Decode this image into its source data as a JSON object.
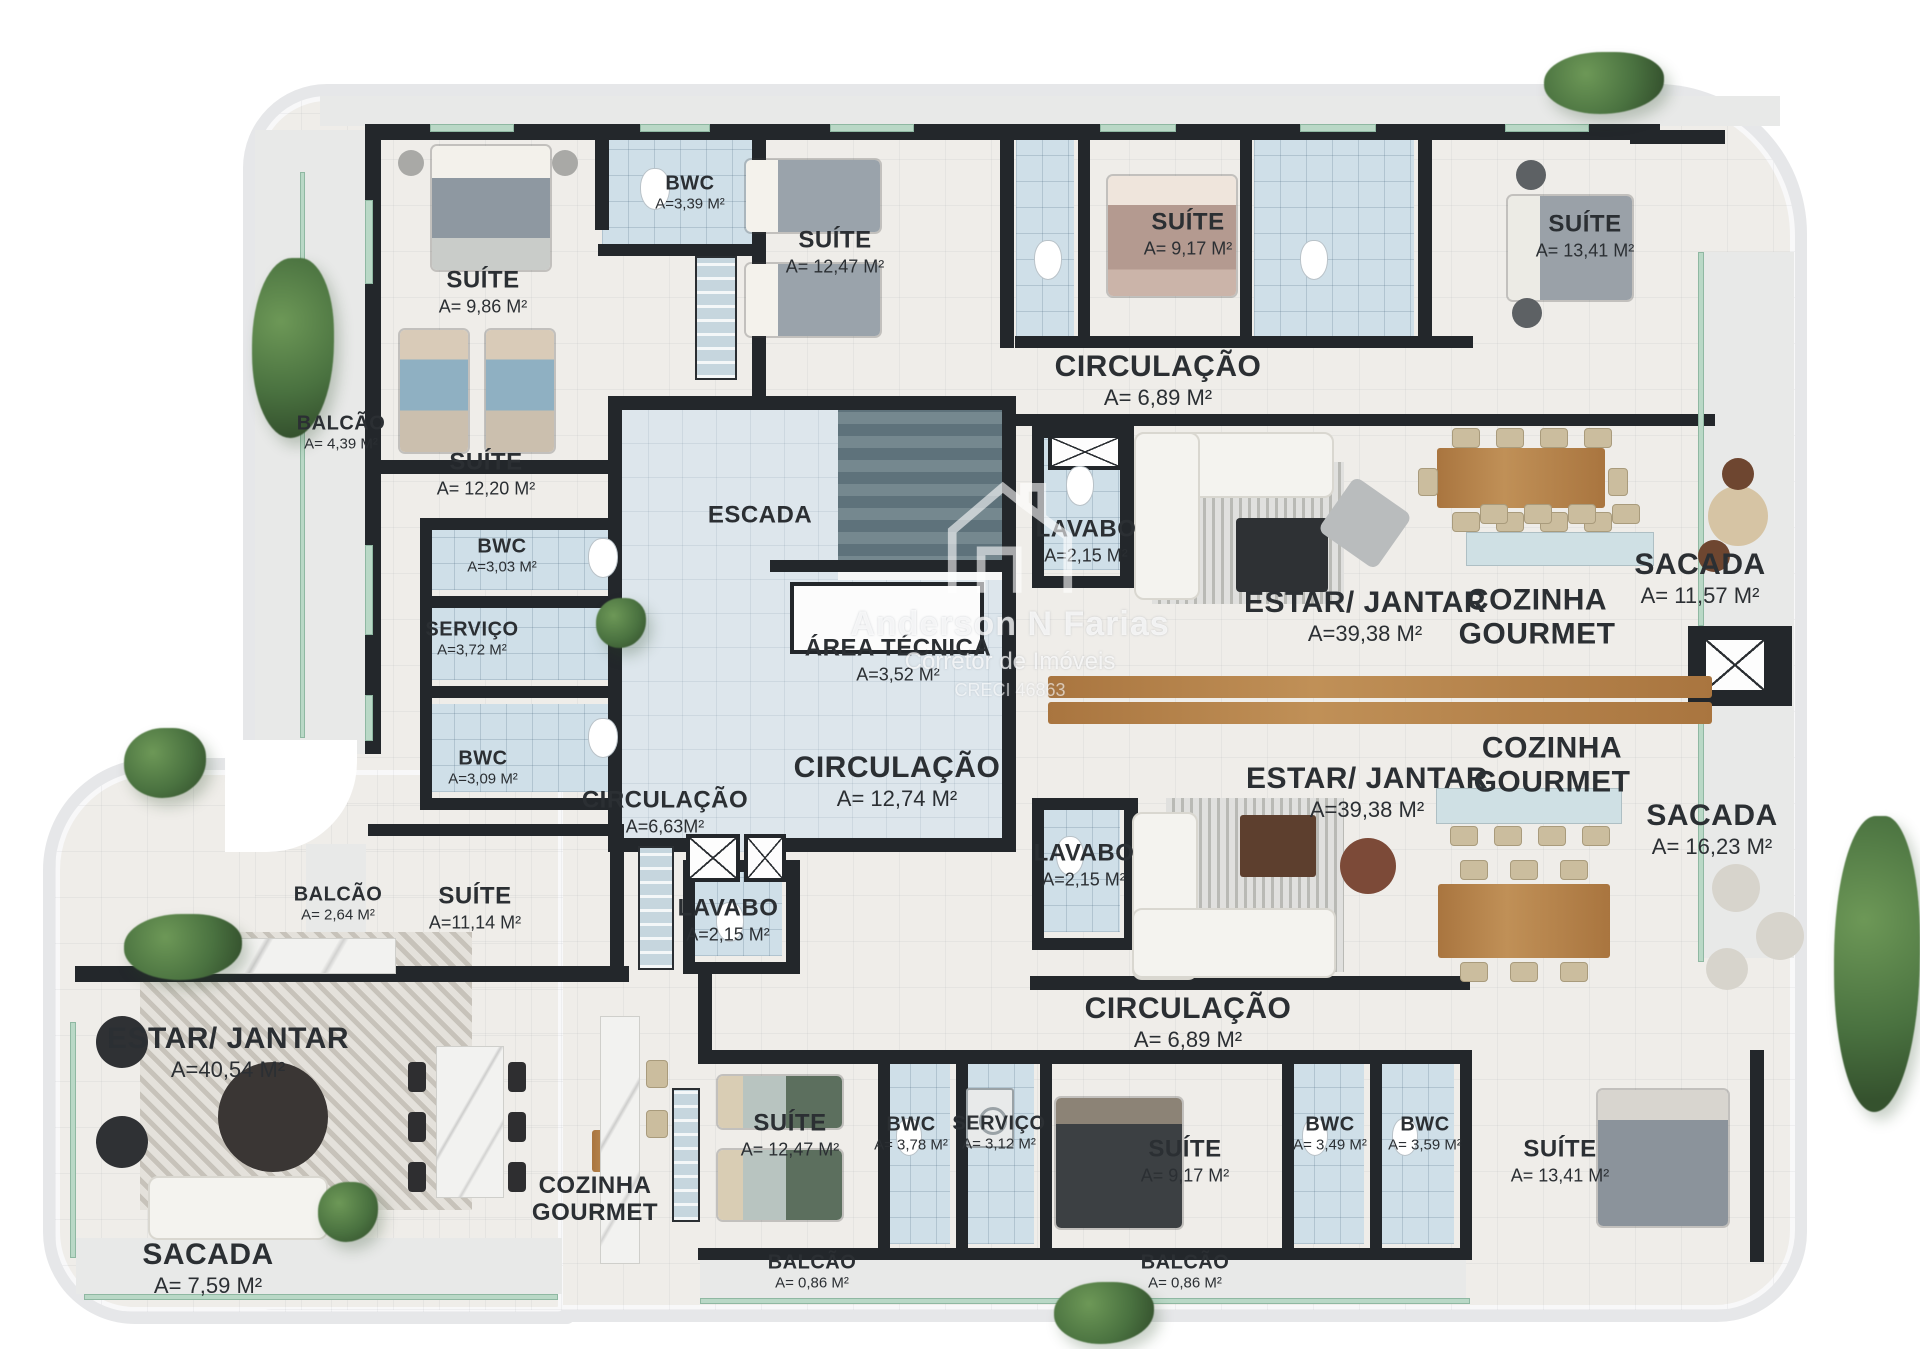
{
  "watermark": {
    "line1": "Anderson N Farias",
    "line2": "Corretor de Imóveis",
    "line3": "CRECI 46863"
  },
  "rooms": [
    {
      "label": "SUÍTE",
      "area": "A= 9,86 m²",
      "x": 483,
      "y": 292,
      "size": "m"
    },
    {
      "label": "BWC",
      "area": "A=3,39 m²",
      "x": 690,
      "y": 193,
      "size": "s"
    },
    {
      "label": "SUÍTE",
      "area": "A= 12,47 m²",
      "x": 835,
      "y": 252,
      "size": "m"
    },
    {
      "label": "SUÍTE",
      "area": "A= 9,17 m²",
      "x": 1188,
      "y": 234,
      "size": "m"
    },
    {
      "label": "SUÍTE",
      "area": "A= 13,41 m²",
      "x": 1585,
      "y": 236,
      "size": "m"
    },
    {
      "label": "CIRCULAÇÃO",
      "area": "A= 6,89 m²",
      "x": 1158,
      "y": 380,
      "size": "l"
    },
    {
      "label": "BALCÃO",
      "area": "A= 4,39 m²",
      "x": 341,
      "y": 433,
      "size": "s"
    },
    {
      "label": "SUÍTE",
      "area": "A= 12,20 m²",
      "x": 486,
      "y": 474,
      "size": "m"
    },
    {
      "label": "BWC",
      "area": "A=3,03 m²",
      "x": 502,
      "y": 556,
      "size": "s"
    },
    {
      "label": "SERVIÇO",
      "area": "A=3,72 m²",
      "x": 472,
      "y": 639,
      "size": "s"
    },
    {
      "label": "BWC",
      "area": "A=3,09 m²",
      "x": 483,
      "y": 768,
      "size": "s"
    },
    {
      "label": "ESCADA",
      "area": "",
      "x": 760,
      "y": 516,
      "size": "m"
    },
    {
      "label": "ÁREA TÉCNICA",
      "area": "A=3,52 m²",
      "x": 898,
      "y": 660,
      "size": "m"
    },
    {
      "label": "LAVABO",
      "area": "A=2,15 m²",
      "x": 1086,
      "y": 541,
      "size": "m"
    },
    {
      "label": "ESTAR/ JANTAR",
      "area": "A=39,38 m²",
      "x": 1365,
      "y": 616,
      "size": "l"
    },
    {
      "label": "COZINHA\nGOURMET",
      "area": "",
      "x": 1537,
      "y": 617,
      "size": "l"
    },
    {
      "label": "SACADA",
      "area": "A= 11,57 m²",
      "x": 1700,
      "y": 578,
      "size": "l"
    },
    {
      "label": "CIRCULAÇÃO",
      "area": "A= 12,74 m²",
      "x": 897,
      "y": 781,
      "size": "l"
    },
    {
      "label": "CIRCULAÇÃO",
      "area": "A=6,63m²",
      "x": 665,
      "y": 812,
      "size": "m"
    },
    {
      "label": "ESTAR/ JANTAR",
      "area": "A=39,38 m²",
      "x": 1367,
      "y": 792,
      "size": "l"
    },
    {
      "label": "COZINHA\nGOURMET",
      "area": "",
      "x": 1552,
      "y": 765,
      "size": "l"
    },
    {
      "label": "SACADA",
      "area": "A= 16,23 m²",
      "x": 1712,
      "y": 829,
      "size": "l"
    },
    {
      "label": "LAVABO",
      "area": "A=2,15 m²",
      "x": 1084,
      "y": 865,
      "size": "m"
    },
    {
      "label": "BALCÃO",
      "area": "A= 2,64 m²",
      "x": 338,
      "y": 904,
      "size": "s"
    },
    {
      "label": "SUÍTE",
      "area": "A=11,14 m²",
      "x": 475,
      "y": 908,
      "size": "m"
    },
    {
      "label": "LAVABO",
      "area": "A=2,15 m²",
      "x": 728,
      "y": 920,
      "size": "m"
    },
    {
      "label": "ESTAR/ JANTAR",
      "area": "A=40,54 m²",
      "x": 228,
      "y": 1052,
      "size": "l"
    },
    {
      "label": "COZINHA\nGOURMET",
      "area": "",
      "x": 595,
      "y": 1200,
      "size": "m"
    },
    {
      "label": "SACADA",
      "area": "A= 7,59 m²",
      "x": 208,
      "y": 1268,
      "size": "l"
    },
    {
      "label": "CIRCULAÇÃO",
      "area": "A= 6,89 m²",
      "x": 1188,
      "y": 1022,
      "size": "l"
    },
    {
      "label": "SUÍTE",
      "area": "A= 12,47 m²",
      "x": 790,
      "y": 1135,
      "size": "m"
    },
    {
      "label": "BWC",
      "area": "A= 3,78 m²",
      "x": 911,
      "y": 1134,
      "size": "s"
    },
    {
      "label": "SERVIÇO",
      "area": "A= 3,12 m²",
      "x": 999,
      "y": 1133,
      "size": "s"
    },
    {
      "label": "SUÍTE",
      "area": "A= 9,17 m²",
      "x": 1185,
      "y": 1161,
      "size": "m"
    },
    {
      "label": "BWC",
      "area": "A= 3,49 m²",
      "x": 1330,
      "y": 1134,
      "size": "s"
    },
    {
      "label": "BWC",
      "area": "A= 3,59 m²",
      "x": 1425,
      "y": 1134,
      "size": "s"
    },
    {
      "label": "SUÍTE",
      "area": "A= 13,41 m²",
      "x": 1560,
      "y": 1161,
      "size": "m"
    },
    {
      "label": "BALCÃO",
      "area": "A= 0,86 m²",
      "x": 812,
      "y": 1272,
      "size": "s"
    },
    {
      "label": "BALCÃO",
      "area": "A= 0,86 m²",
      "x": 1185,
      "y": 1272,
      "size": "s"
    }
  ]
}
